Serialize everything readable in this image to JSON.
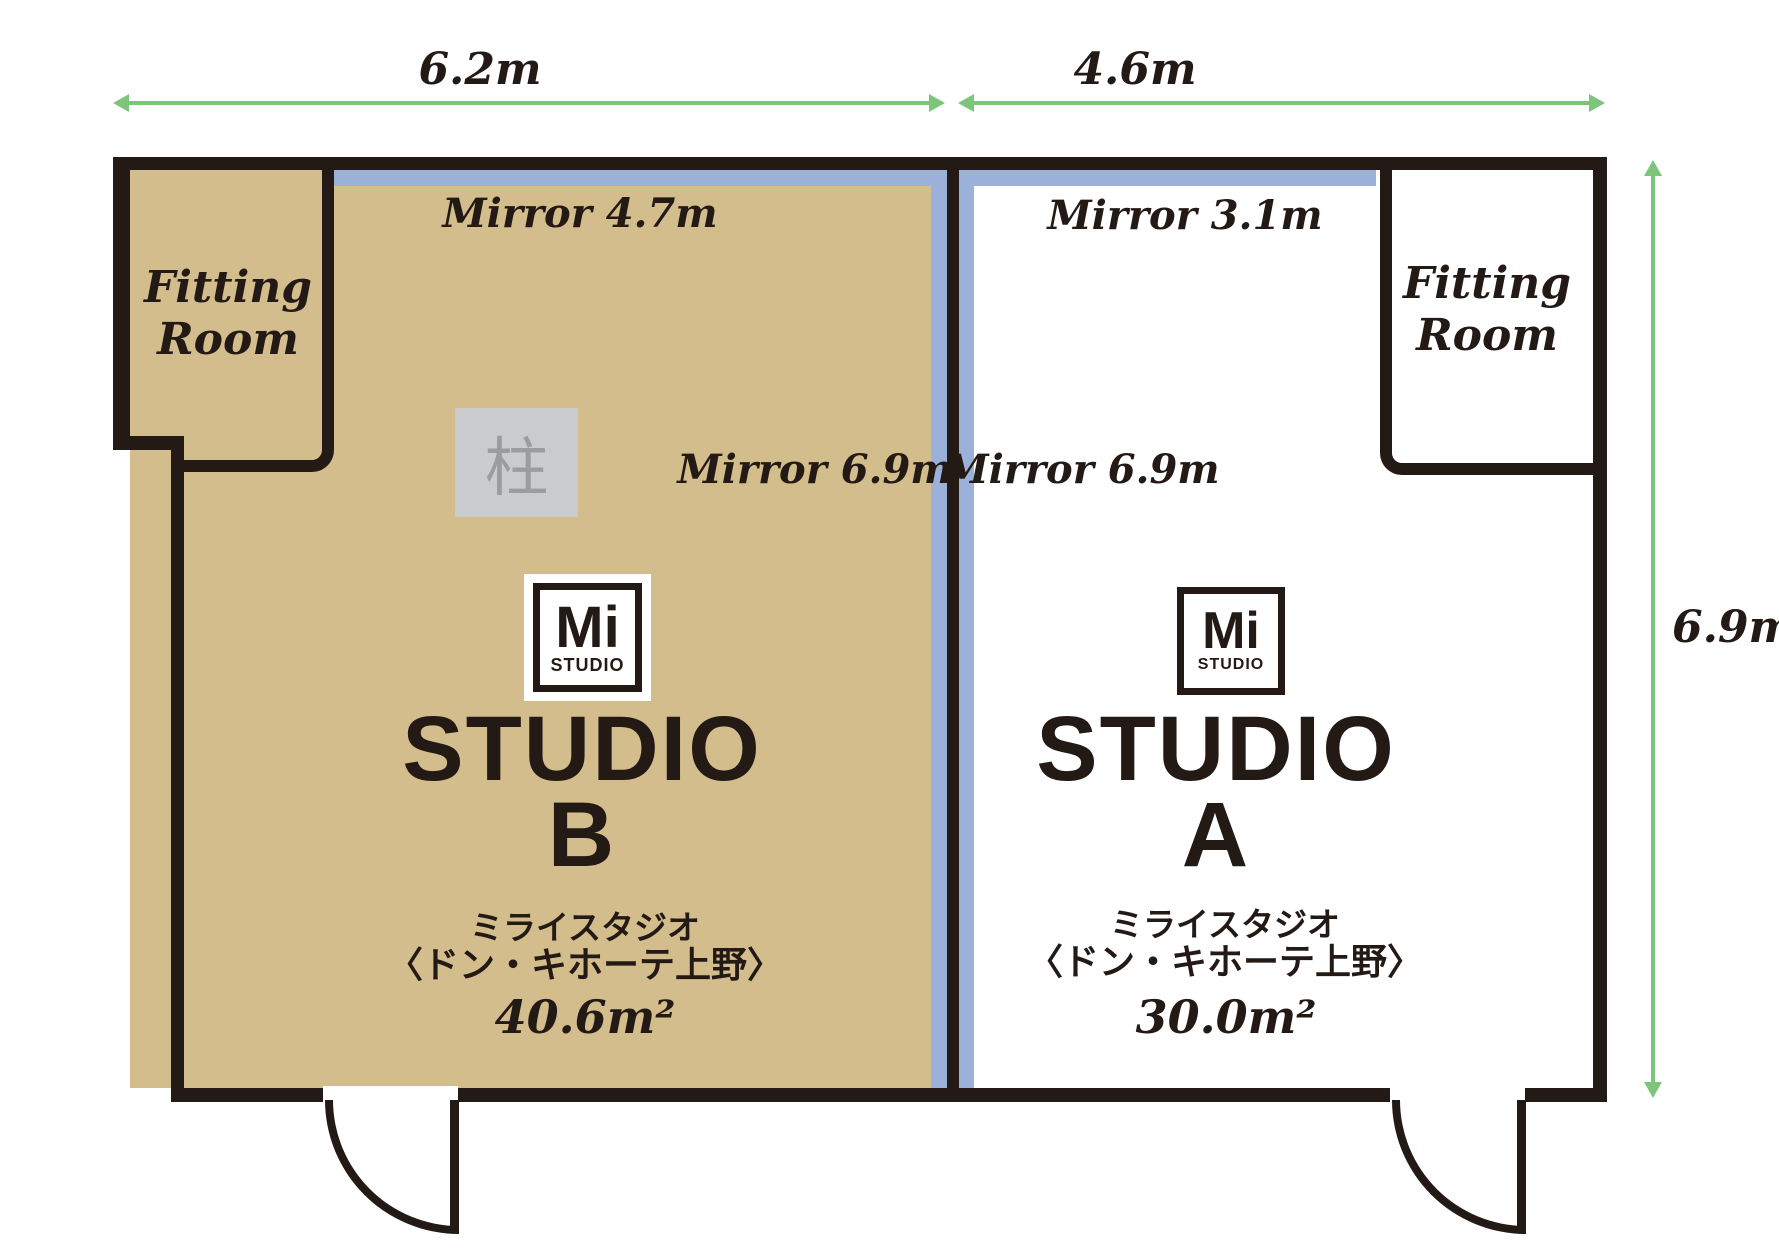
{
  "dimensions": {
    "top_left": "6.2m",
    "top_right": "4.6m",
    "right": "6.9m"
  },
  "brand": {
    "mi": "Mi",
    "studio": "STUDIO"
  },
  "studio_b": {
    "title_line1": "STUDIO",
    "title_line2": "B",
    "mirror_top": "Mirror 4.7m",
    "mirror_side": "Mirror 6.9m",
    "fitting_line1": "Fitting",
    "fitting_line2": "Room",
    "pillar": "柱",
    "jp_line1": "ミライスタジオ",
    "jp_line2": "〈ドン・キホーテ上野〉",
    "area": "40.6m²"
  },
  "studio_a": {
    "title_line1": "STUDIO",
    "title_line2": "A",
    "mirror_top": "Mirror 3.1m",
    "mirror_side": "Mirror 6.9m",
    "fitting_line1": "Fitting",
    "fitting_line2": "Room",
    "jp_line1": "ミライスタジオ",
    "jp_line2": "〈ドン・キホーテ上野〉",
    "area": "30.0m²"
  },
  "colors": {
    "wall": "#241a15",
    "studio_b_floor": "#d3bd8c",
    "mirror": "#9bb1da",
    "dimension_arrow": "#7dc57a",
    "pillar_fill": "#cacbcc",
    "pillar_text": "#9b9c9e"
  }
}
